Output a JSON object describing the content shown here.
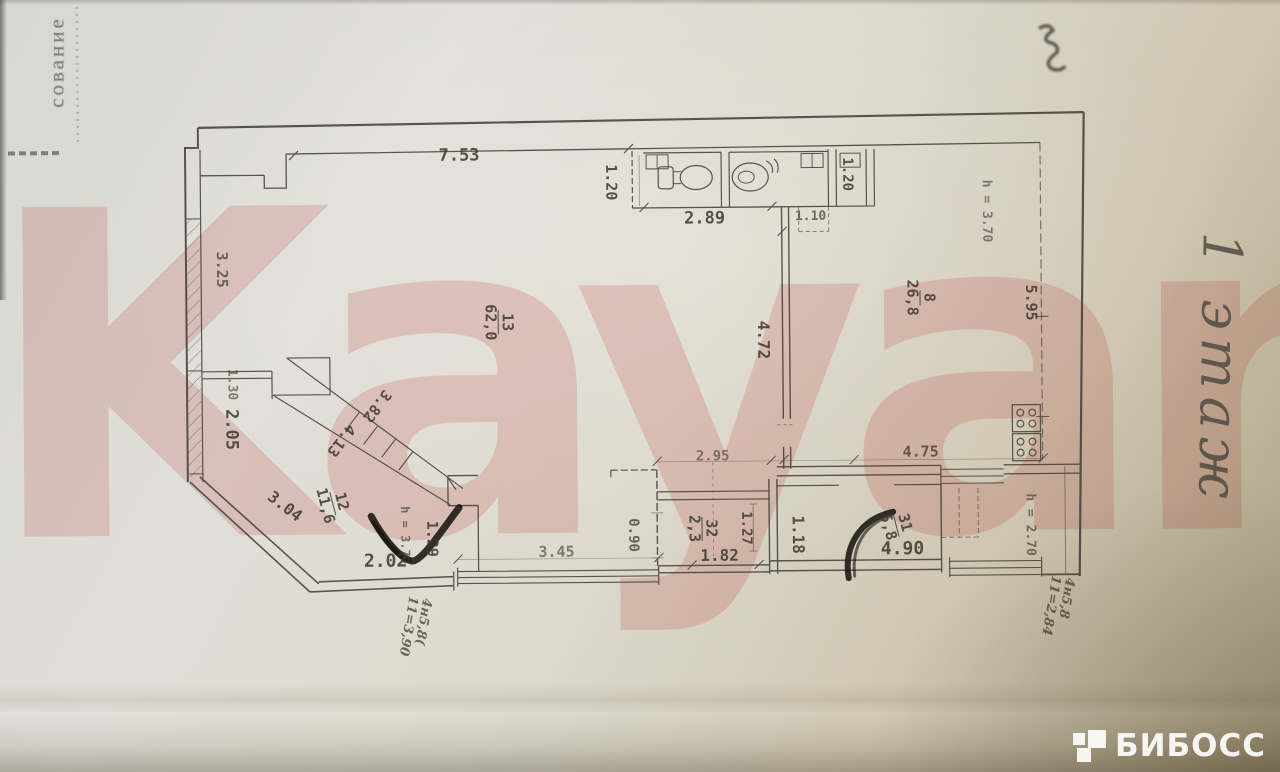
{
  "stamp": {
    "text": "сование"
  },
  "watermark": {
    "text": "Kayan",
    "color": "#e07474"
  },
  "floor_label": {
    "text": "1 этаж"
  },
  "logo": {
    "text": "БИБОСС"
  },
  "plan": {
    "ink_color": "#45413a",
    "dimensions": [
      {
        "t": "7.53",
        "x": 461,
        "y": 154,
        "r": 0,
        "s": 17
      },
      {
        "t": "1.20",
        "x": 613,
        "y": 182,
        "r": 90,
        "s": 15
      },
      {
        "t": "2.89",
        "x": 706,
        "y": 219,
        "r": 0,
        "s": 17
      },
      {
        "t": "1.10",
        "x": 812,
        "y": 218,
        "r": 0,
        "s": 13,
        "o": 0.7
      },
      {
        "t": "1.20",
        "x": 849,
        "y": 176,
        "r": 90,
        "s": 14
      },
      {
        "t": "h = 3.70",
        "x": 988,
        "y": 214,
        "r": 90,
        "s": 13,
        "o": 0.6
      },
      {
        "t": "5.95",
        "x": 1032,
        "y": 306,
        "r": 90,
        "s": 15
      },
      {
        "t": "3.25",
        "x": 223,
        "y": 266,
        "r": 90,
        "s": 15,
        "o": 0.7
      },
      {
        "t": "4.72",
        "x": 764,
        "y": 341,
        "r": 90,
        "s": 16
      },
      {
        "t": "1.30",
        "x": 232,
        "y": 381,
        "r": 90,
        "s": 13,
        "o": 0.6
      },
      {
        "t": "2.05",
        "x": 231,
        "y": 426,
        "r": 90,
        "s": 17
      },
      {
        "t": "3.82",
        "x": 377,
        "y": 404,
        "r": 128,
        "s": 15
      },
      {
        "t": "4.13",
        "x": 341,
        "y": 438,
        "r": 128,
        "s": 15
      },
      {
        "t": "3.04",
        "x": 284,
        "y": 503,
        "r": 38,
        "s": 16
      },
      {
        "t": "h = 3.70",
        "x": 404,
        "y": 533,
        "r": 90,
        "s": 12,
        "o": 0.65
      },
      {
        "t": "1.29",
        "x": 431,
        "y": 537,
        "r": 90,
        "s": 15
      },
      {
        "t": "2.02",
        "x": 384,
        "y": 559,
        "r": 0,
        "s": 18
      },
      {
        "t": "3.45",
        "x": 555,
        "y": 551,
        "r": 0,
        "s": 15,
        "o": 0.6
      },
      {
        "t": "0.90",
        "x": 632,
        "y": 535,
        "r": 90,
        "s": 14,
        "o": 0.75
      },
      {
        "t": "2.95",
        "x": 712,
        "y": 457,
        "r": 0,
        "s": 14,
        "o": 0.6
      },
      {
        "t": "4.75",
        "x": 920,
        "y": 454,
        "r": 0,
        "s": 15,
        "o": 0.75
      },
      {
        "t": "1.27",
        "x": 745,
        "y": 529,
        "r": 90,
        "s": 14
      },
      {
        "t": "1.82",
        "x": 718,
        "y": 556,
        "r": 0,
        "s": 16
      },
      {
        "t": "1.18",
        "x": 797,
        "y": 536,
        "r": 90,
        "s": 16
      },
      {
        "t": "4.90",
        "x": 901,
        "y": 551,
        "r": 0,
        "s": 18
      },
      {
        "t": "h = 2.70",
        "x": 1029,
        "y": 528,
        "r": 90,
        "s": 13,
        "o": 0.65
      }
    ],
    "room_labels": [
      {
        "num": "13",
        "area": "62,0",
        "x": 499,
        "y": 321,
        "r": 90
      },
      {
        "num": "8",
        "area": "26,8",
        "x": 921,
        "y": 300,
        "r": 90
      },
      {
        "num": "12",
        "area": "11,6",
        "x": 332,
        "y": 501,
        "r": 76
      },
      {
        "num": "32",
        "area": "2,3",
        "x": 701,
        "y": 529,
        "r": 90
      },
      {
        "num": "31",
        "area": "5,8",
        "x": 895,
        "y": 527,
        "r": 76
      }
    ],
    "annotations": [
      {
        "l1": "4н5,8(",
        "l2": "11=3,90",
        "x": 412,
        "y": 625,
        "r": 100
      },
      {
        "l1": "4н5,8",
        "l2": "11=2,84",
        "x": 1055,
        "y": 610,
        "r": 100
      }
    ]
  }
}
